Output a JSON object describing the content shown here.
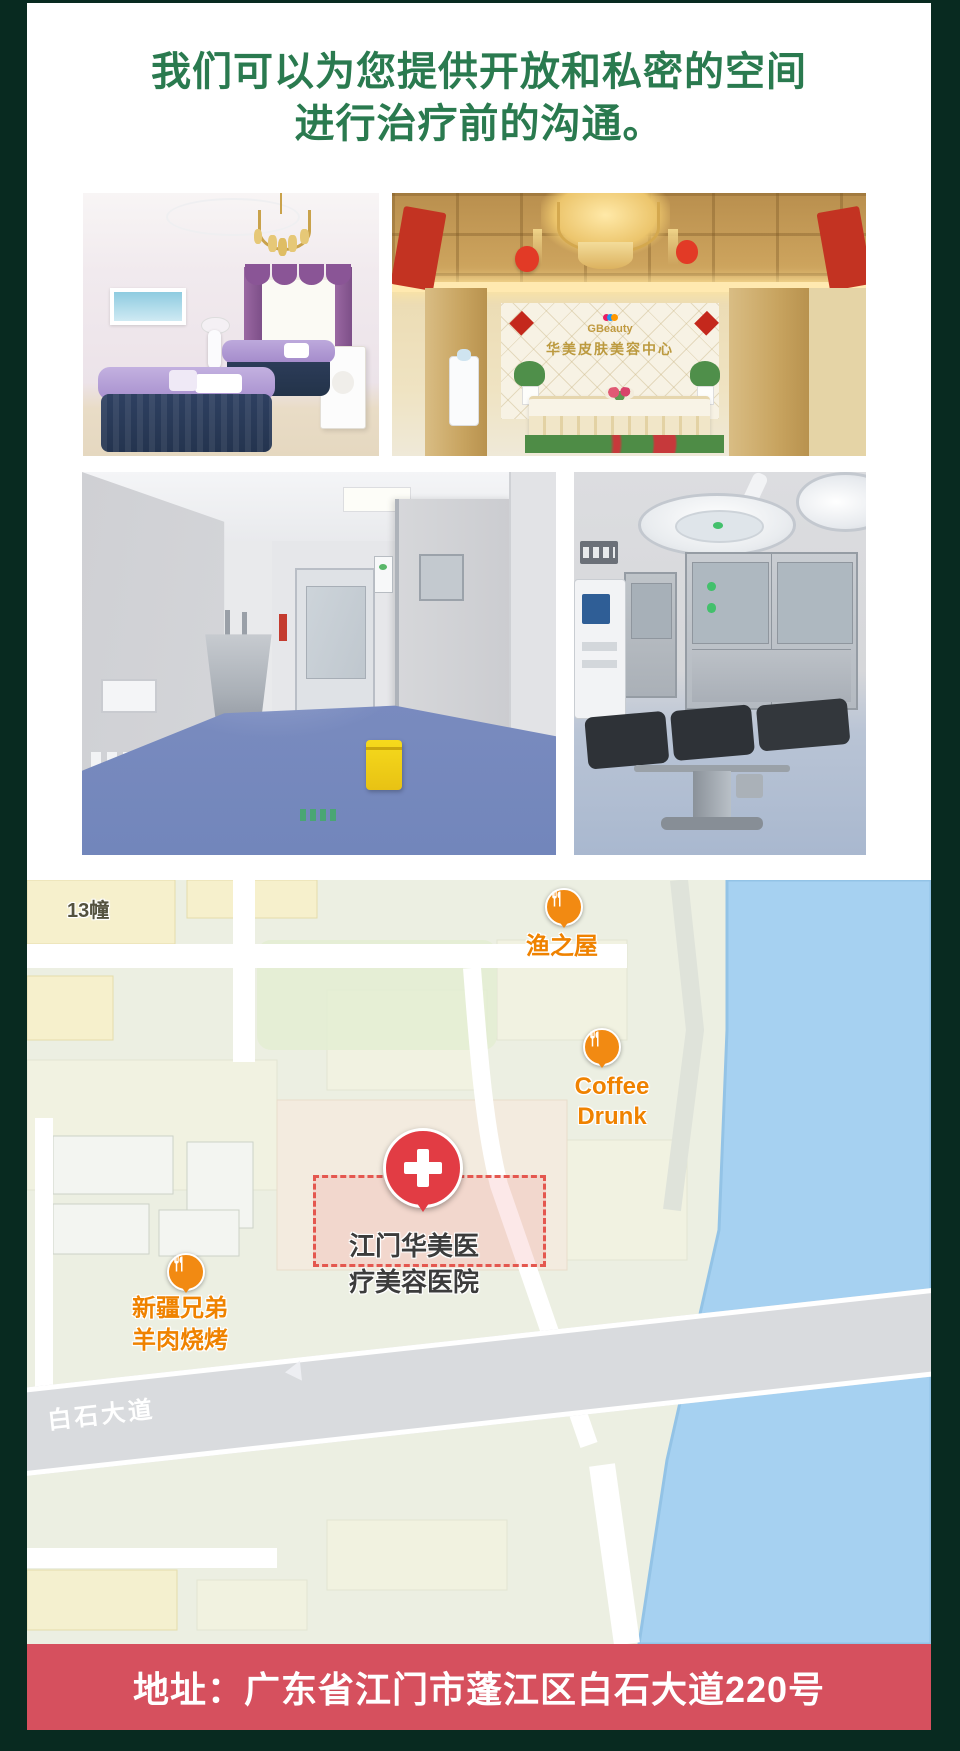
{
  "header": {
    "title_line1": "我们可以为您提供开放和私密的空间",
    "title_line2": "进行治疗前的沟通。"
  },
  "photos": {
    "lobby": {
      "logo_text": "GBeauty",
      "sign_text": "华美皮肤美容中心"
    }
  },
  "map": {
    "labels": {
      "building": "13幢",
      "road": "白石大道"
    },
    "pois": {
      "fish_house": {
        "name": "渔之屋"
      },
      "coffee": {
        "line1": "Coffee",
        "line2": "Drunk"
      },
      "hospital": {
        "line1": "江门华美医",
        "line2": "疗美容医院"
      },
      "bbq": {
        "line1": "新疆兄弟",
        "line2": "羊肉烧烤"
      }
    }
  },
  "footer": {
    "address": "地址：广东省江门市蓬江区白石大道220号"
  },
  "colors": {
    "frame_green": "#082a20",
    "heading_green": "#2a7a4f",
    "banner_red": "#d6505e",
    "poi_orange": "#ef8200",
    "hospital_red": "#e23c44",
    "water_blue": "#a6d1f1"
  }
}
